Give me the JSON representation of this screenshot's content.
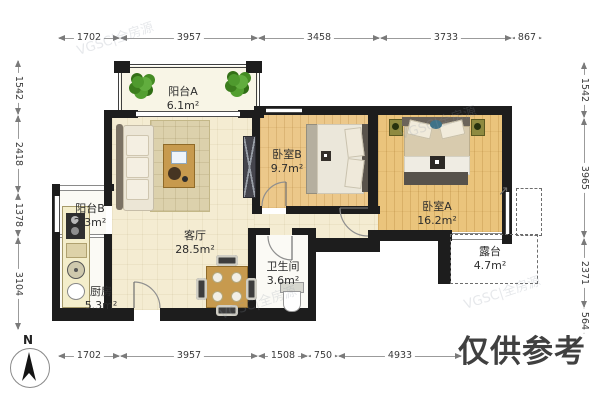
{
  "plan": {
    "rooms": [
      {
        "id": "balcony_a",
        "name": "阳台A",
        "area": "6.1m²"
      },
      {
        "id": "bedroom_b",
        "name": "卧室B",
        "area": "9.7m²"
      },
      {
        "id": "bedroom_a",
        "name": "卧室A",
        "area": "16.2m²"
      },
      {
        "id": "balcony_b",
        "name": "阳台B",
        "area": "2.3m²"
      },
      {
        "id": "living_room",
        "name": "客厅",
        "area": "28.5m²"
      },
      {
        "id": "bathroom",
        "name": "卫生间",
        "area": "3.6m²"
      },
      {
        "id": "kitchen",
        "name": "厨房",
        "area": "5.3m²"
      },
      {
        "id": "terrace",
        "name": "露台",
        "area": "4.7m²"
      }
    ],
    "compass_label": "N"
  },
  "dimensions": {
    "top": [
      "1702",
      "3957",
      "3458",
      "3733",
      "867"
    ],
    "bottom": [
      "1702",
      "3957",
      "1508",
      "750",
      "4933"
    ],
    "left": [
      "1542",
      "2418",
      "1378",
      "3104"
    ],
    "right": [
      "1542",
      "3965",
      "2371",
      "564"
    ]
  },
  "watermarks": {
    "reference_note": "仅供参考",
    "diagonal_text": "VGSC|全房源"
  },
  "colors": {
    "wall": "#1d1d1d",
    "living_floor": "#f4ecd2",
    "bedroom_floor": "#eac47c",
    "balcony_floor": "#f8f5e6",
    "plant_green": "#4f9a2e",
    "note_gray": "#404040"
  }
}
